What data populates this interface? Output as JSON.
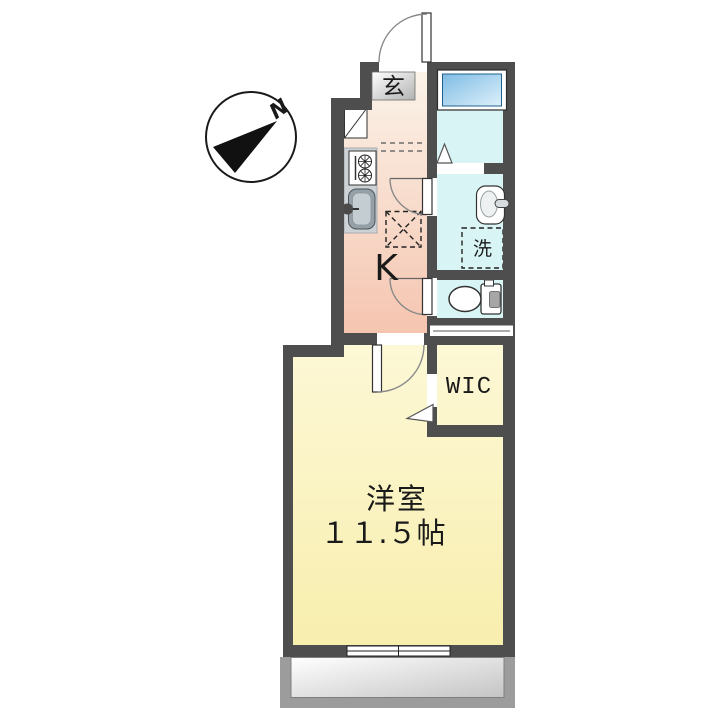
{
  "floorplan": {
    "title": "apartment-floorplan",
    "labels": {
      "compass_north": "N",
      "entrance": "玄",
      "kitchen": "K",
      "laundry": "洗",
      "walk_in_closet": "WIC",
      "main_room_name": "洋室",
      "main_room_size": "１１.５帖"
    },
    "colors": {
      "wall": "#4e4e4e",
      "kitchen_top": "#fbf3e9",
      "kitchen_bottom": "#f5c5b0",
      "bath": "#d9f4f4",
      "tub_top": "#7fbce4",
      "tub_bottom": "#ddf0fa",
      "wic_top": "#fce4c0",
      "wic_bottom": "#edad60",
      "room_top": "#fdf8d6",
      "room_bottom": "#f8eeae",
      "balcony_outer": "#9c9c9c",
      "balcony_inner_top": "#ffffff",
      "balcony_inner_bottom": "#c4c4c4",
      "genkan_box_top": "#ffffff",
      "genkan_box_bottom": "#b2b2b2"
    }
  }
}
